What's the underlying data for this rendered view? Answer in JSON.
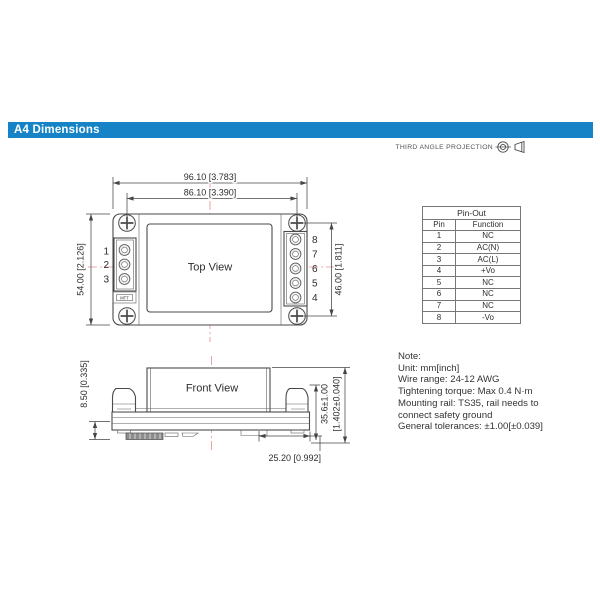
{
  "header": {
    "title": "A4 Dimensions"
  },
  "projection": {
    "label": "THIRD ANGLE PROJECTION"
  },
  "top_view": {
    "label": "Top View",
    "brand_mark": "MTT",
    "left_pins": [
      "1",
      "2",
      "3"
    ],
    "right_pins": [
      "8",
      "7",
      "6",
      "5",
      "4"
    ],
    "dims": {
      "overall_width": "96.10 [3.783]",
      "mounting_width": "86.10 [3.390]",
      "overall_height": "54.00 [2.126]",
      "mounting_height": "46.00 [1.811]"
    }
  },
  "front_view": {
    "label": "Front View",
    "dims": {
      "clip_height": "8.50 [0.335]",
      "total_height_mm": "35.6±1.00",
      "total_height_inch": "[1.402±0.040]",
      "depth": "25.20 [0.992]"
    }
  },
  "pinout": {
    "title": "Pin-Out",
    "columns": [
      "Pin",
      "Function"
    ],
    "rows": [
      {
        "pin": "1",
        "function": "NC"
      },
      {
        "pin": "2",
        "function": "AC(N)"
      },
      {
        "pin": "3",
        "function": "AC(L)"
      },
      {
        "pin": "4",
        "function": "+Vo"
      },
      {
        "pin": "5",
        "function": "NC"
      },
      {
        "pin": "6",
        "function": "NC"
      },
      {
        "pin": "7",
        "function": "NC"
      },
      {
        "pin": "8",
        "function": "-Vo"
      }
    ]
  },
  "note": {
    "lines": [
      "Note:",
      "Unit: mm[inch]",
      "Wire range: 24-12 AWG",
      "Tightening torque: Max 0.4 N·m",
      "Mounting rail: TS35, rail needs to",
      "connect safety ground",
      "General tolerances: ±1.00[±0.039]"
    ]
  },
  "colors": {
    "accent_blue": "#1583c5",
    "centerline_red": "#e59090",
    "line_gray": "#4a4a4a"
  }
}
